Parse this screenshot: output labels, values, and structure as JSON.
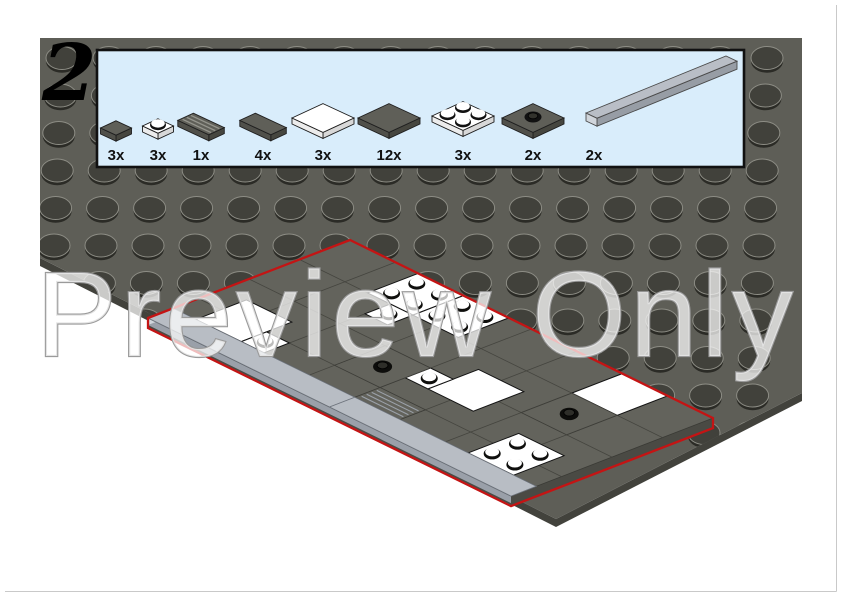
{
  "page": {
    "step_number": "2",
    "watermark_text": "Preview Only"
  },
  "colors": {
    "baseplate_top": "#5e5e57",
    "baseplate_edge": "#42423c",
    "stud_top": "#41413b",
    "stud_rim": "#8d8d85",
    "stud_shadow": "#2b2b26",
    "assembly_top": "#63635c",
    "assembly_side": "#4a4a44",
    "assembly_seam": "#45453f",
    "strip_top": "#b8bdc4",
    "strip_side": "#9aa0a9",
    "strip_cap": "#d0d5db",
    "parts_box_bg": "#d9edfb",
    "parts_box_border": "#111111",
    "dark_part": "#5f5f58",
    "white_part": "#ffffff",
    "light_gray_part": "#b9bec6",
    "step_outline_red": "#c41414",
    "watermark_fill": "rgba(255,255,255,0.72)",
    "watermark_stroke": "#9a9a9a"
  },
  "parts_box": {
    "parts": [
      {
        "qty_label": "3x",
        "name": "tile-1x1-dark-gray"
      },
      {
        "qty_label": "3x",
        "name": "plate-1x1-white-with-stud"
      },
      {
        "qty_label": "1x",
        "name": "grille-tile-1x2-dark-gray"
      },
      {
        "qty_label": "4x",
        "name": "tile-1x2-dark-gray"
      },
      {
        "qty_label": "3x",
        "name": "tile-2x2-white"
      },
      {
        "qty_label": "12x",
        "name": "tile-2x2-dark-gray"
      },
      {
        "qty_label": "3x",
        "name": "plate-2x2-white-with-studs"
      },
      {
        "qty_label": "2x",
        "name": "plate-2x2-dark-gray-center-stud"
      },
      {
        "qty_label": "2x",
        "name": "tile-1x8-light-gray"
      }
    ]
  },
  "assembly": {
    "grid": {
      "cols": 16,
      "rows": 8
    },
    "pieces": [
      {
        "name": "tile-2x2-white-a",
        "type": "tile",
        "color": "white",
        "u": 1,
        "v": 5,
        "w": 2,
        "h": 2
      },
      {
        "name": "tile-2x2-white-b",
        "type": "tile",
        "color": "white",
        "u": 9,
        "v": 3,
        "w": 2,
        "h": 2
      },
      {
        "name": "tile-2x2-white-c",
        "type": "tile",
        "color": "white",
        "u": 12,
        "v": 0,
        "w": 2,
        "h": 2
      },
      {
        "name": "plate-2x2-white-studs-a",
        "type": "plate_studs",
        "color": "white",
        "u": 3,
        "v": 0,
        "w": 2,
        "h": 2
      },
      {
        "name": "plate-2x2-white-studs-b",
        "type": "plate_studs",
        "color": "white",
        "u": 5,
        "v": 0,
        "w": 2,
        "h": 2
      },
      {
        "name": "plate-2x2-white-studs-c",
        "type": "plate_studs",
        "color": "white",
        "u": 13,
        "v": 5,
        "w": 2,
        "h": 2
      },
      {
        "name": "plate-1x1-white-stud-a",
        "type": "plate_stud1",
        "color": "white",
        "u": 4,
        "v": 2,
        "w": 1,
        "h": 1
      },
      {
        "name": "plate-1x1-white-stud-b",
        "type": "plate_stud1",
        "color": "white",
        "u": 8,
        "v": 4,
        "w": 1,
        "h": 1
      },
      {
        "name": "plate-1x1-white-stud-c",
        "type": "plate_stud1",
        "color": "white",
        "u": 3,
        "v": 6,
        "w": 1,
        "h": 1
      },
      {
        "name": "plate-2x2-dark-center-stud-a",
        "type": "jumper",
        "color": "dark",
        "u": 6,
        "v": 4,
        "w": 2,
        "h": 2
      },
      {
        "name": "plate-2x2-dark-center-stud-b",
        "type": "jumper",
        "color": "dark",
        "u": 12,
        "v": 2,
        "w": 2,
        "h": 2
      },
      {
        "name": "grille-tile-1x2",
        "type": "grille",
        "color": "dark",
        "u": 8,
        "v": 6,
        "w": 2,
        "h": 1
      },
      {
        "name": "tile-1x8-light-a",
        "type": "strip",
        "color": "light",
        "u": 0,
        "v": 7,
        "w": 8,
        "h": 1
      },
      {
        "name": "tile-1x8-light-b",
        "type": "strip",
        "color": "light",
        "u": 8,
        "v": 7,
        "w": 8,
        "h": 1
      }
    ]
  }
}
